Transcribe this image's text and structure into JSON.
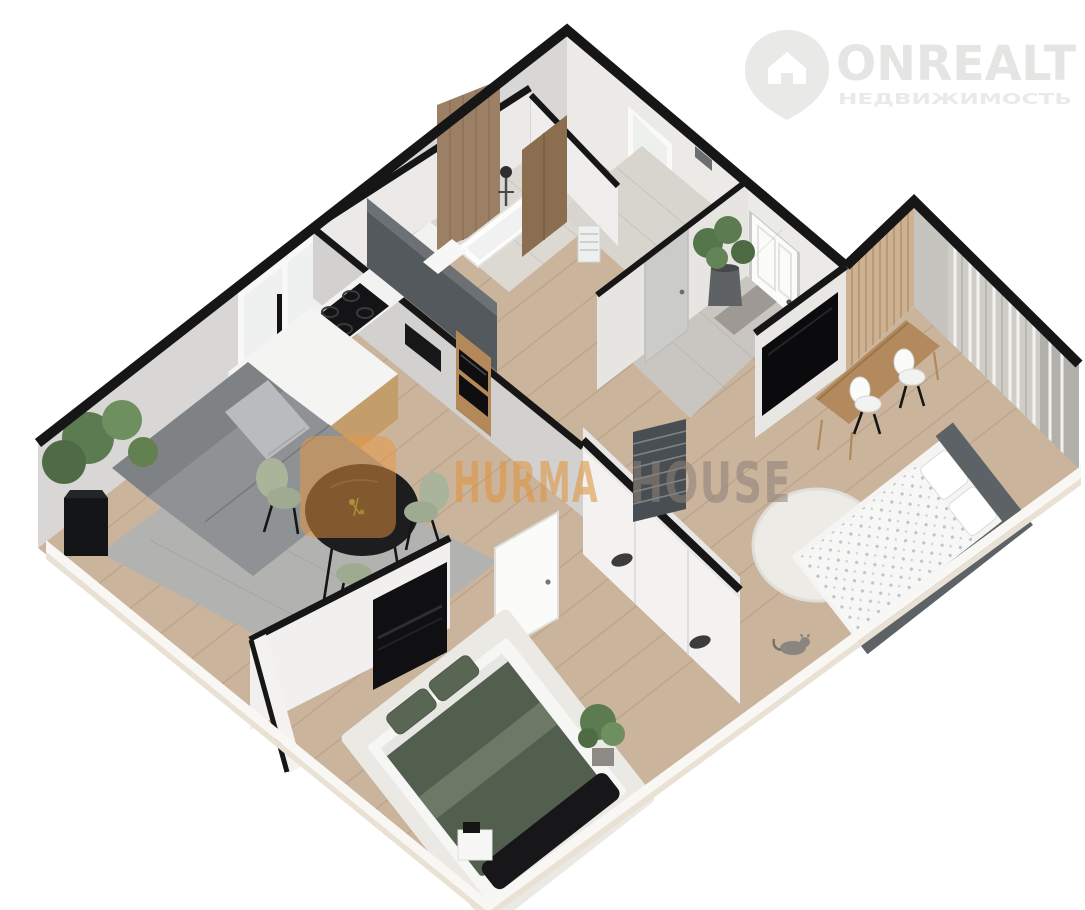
{
  "branding": {
    "name": "ONREALT",
    "tagline": "НЕДВИЖИМОСТЬ",
    "name_color": "#e5e5e4",
    "tagline_color": "#eaeae9",
    "pin_color": "#e9e9e8"
  },
  "watermark": {
    "word1": "HURMA",
    "word2": "HOUSE",
    "word1_color": "#e0953f",
    "word2_color": "#8d8178",
    "icon_color": "#e8963e"
  },
  "scene": {
    "description": "3D isometric floor plan render of a two-bedroom apartment",
    "rooms": [
      "living-room-kitchen",
      "bathroom",
      "laundry",
      "entry-hall",
      "kids-bedroom",
      "bedroom"
    ]
  },
  "palette": {
    "background": "#ffffff",
    "floor_wood": "#cbb49c",
    "bath_tile": "#dcd8d2",
    "hall_tile": "#c9c6c1",
    "wall_cap": "#161616",
    "wall_face_gray": "#d8d7d5",
    "wall_face_light": "#eceae7",
    "sofa_gray": "#8e9295",
    "rug_living": "#b0b2b1",
    "rug_white": "#edebe6",
    "bed_green": "#525e4e",
    "bed_frame_dark": "#5d6266",
    "sage_chair": "#a9b49b",
    "wood_cabinet": "#b4895a",
    "dark_unit": "#54595d",
    "slat_wood": "#cdb193",
    "curtain": "#cfcdc8",
    "plant_green": "#5d7b51"
  }
}
